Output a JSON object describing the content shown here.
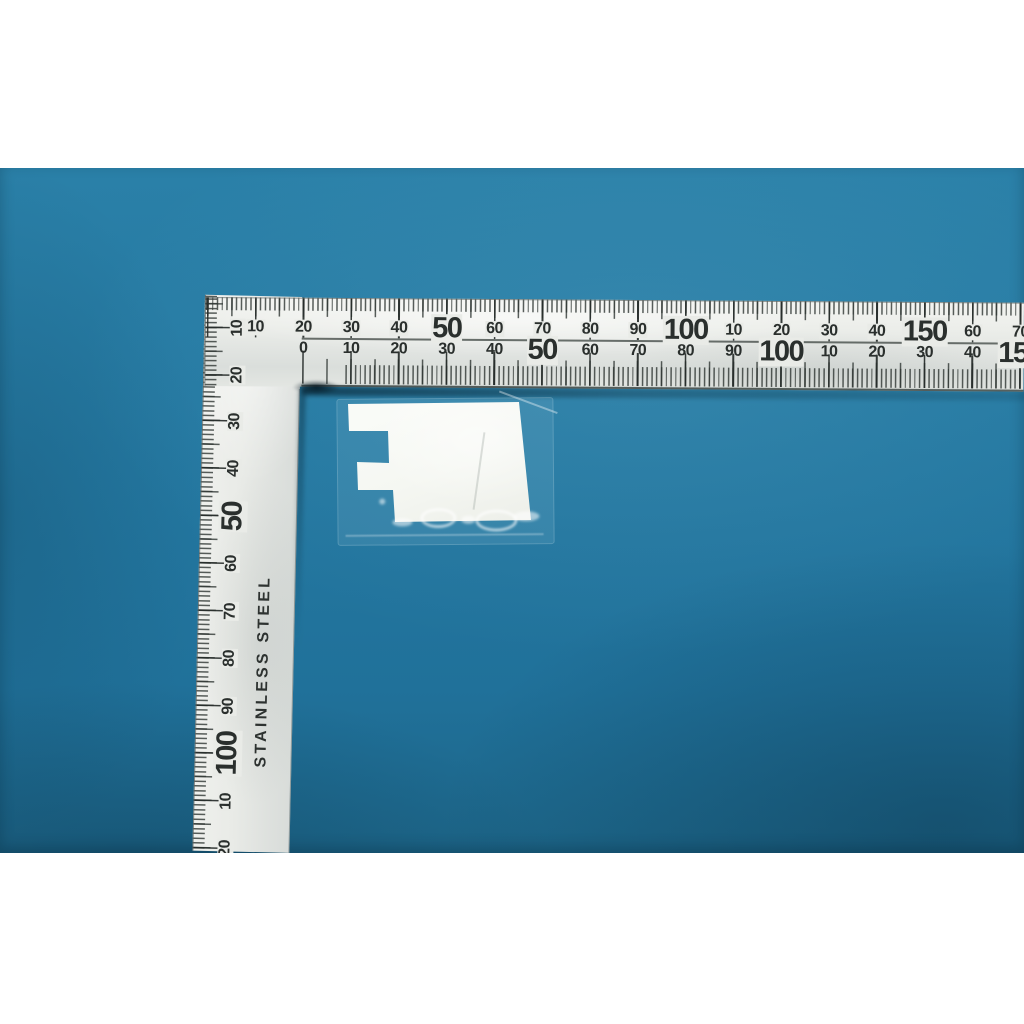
{
  "scene": {
    "letterbox_color": "#ffffff",
    "background_blue": "#2478a1"
  },
  "square": {
    "material_label": "STAINLESS STEEL",
    "body_color": "#e9ebe7",
    "mark_color": "#2a2f2d",
    "scales": {
      "horizontal_upper": [
        {
          "mm": 10,
          "label": "10",
          "big": false
        },
        {
          "mm": 20,
          "label": "20",
          "big": false
        },
        {
          "mm": 30,
          "label": "30",
          "big": false
        },
        {
          "mm": 40,
          "label": "40",
          "big": false
        },
        {
          "mm": 50,
          "label": "50",
          "big": true
        },
        {
          "mm": 60,
          "label": "60",
          "big": false
        },
        {
          "mm": 70,
          "label": "70",
          "big": false
        },
        {
          "mm": 80,
          "label": "80",
          "big": false
        },
        {
          "mm": 90,
          "label": "90",
          "big": false
        },
        {
          "mm": 100,
          "label": "100",
          "big": true
        },
        {
          "mm": 110,
          "label": "10",
          "big": false
        },
        {
          "mm": 120,
          "label": "20",
          "big": false
        },
        {
          "mm": 130,
          "label": "30",
          "big": false
        },
        {
          "mm": 140,
          "label": "40",
          "big": false
        },
        {
          "mm": 150,
          "label": "150",
          "big": true
        },
        {
          "mm": 160,
          "label": "60",
          "big": false
        },
        {
          "mm": 170,
          "label": "70",
          "big": false
        }
      ],
      "horizontal_lower": [
        {
          "mm": 0,
          "label": "0",
          "big": false
        },
        {
          "mm": 10,
          "label": "10",
          "big": false
        },
        {
          "mm": 20,
          "label": "20",
          "big": false
        },
        {
          "mm": 30,
          "label": "30",
          "big": false
        },
        {
          "mm": 40,
          "label": "40",
          "big": false
        },
        {
          "mm": 50,
          "label": "50",
          "big": true
        },
        {
          "mm": 60,
          "label": "60",
          "big": false
        },
        {
          "mm": 70,
          "label": "70",
          "big": false
        },
        {
          "mm": 80,
          "label": "80",
          "big": false
        },
        {
          "mm": 90,
          "label": "90",
          "big": false
        },
        {
          "mm": 100,
          "label": "100",
          "big": true
        },
        {
          "mm": 110,
          "label": "10",
          "big": false
        },
        {
          "mm": 120,
          "label": "20",
          "big": false
        },
        {
          "mm": 130,
          "label": "30",
          "big": false
        },
        {
          "mm": 140,
          "label": "40",
          "big": false
        },
        {
          "mm": 150,
          "label": "150",
          "big": true
        }
      ],
      "vertical": [
        {
          "mm": 10,
          "label": "10",
          "big": false
        },
        {
          "mm": 20,
          "label": "20",
          "big": false
        },
        {
          "mm": 30,
          "label": "30",
          "big": false
        },
        {
          "mm": 40,
          "label": "40",
          "big": false
        },
        {
          "mm": 50,
          "label": "50",
          "big": true
        },
        {
          "mm": 60,
          "label": "60",
          "big": false
        },
        {
          "mm": 70,
          "label": "70",
          "big": false
        },
        {
          "mm": 80,
          "label": "80",
          "big": false
        },
        {
          "mm": 90,
          "label": "90",
          "big": false
        },
        {
          "mm": 100,
          "label": "100",
          "big": true
        },
        {
          "mm": 110,
          "label": "10",
          "big": false
        },
        {
          "mm": 120,
          "label": "20",
          "big": false
        }
      ]
    }
  },
  "object": {
    "pad_color": "#f5f7f2",
    "sleeve_tint": "rgba(208,235,246,0.10)"
  }
}
